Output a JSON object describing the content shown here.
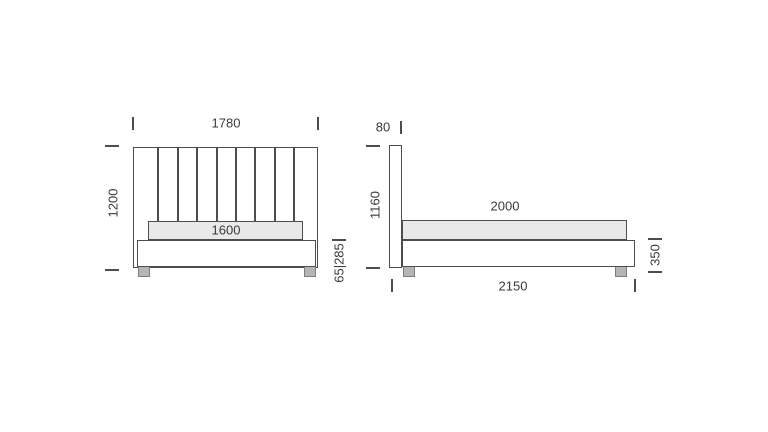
{
  "front_view": {
    "width": "1780",
    "height": "1200",
    "mattress_width": "1600",
    "base_and_leg_height": "65|285"
  },
  "side_view": {
    "headboard_thickness": "80",
    "headboard_height": "1160",
    "mattress_length": "2000",
    "base_height": "350",
    "overall_length": "2150"
  },
  "colors": {
    "background": "#ffffff",
    "line": "#4d4d4d",
    "text": "#3a3a3a",
    "mattress_fill": "#e9e9e9",
    "leg_fill": "#b5b5b5"
  }
}
